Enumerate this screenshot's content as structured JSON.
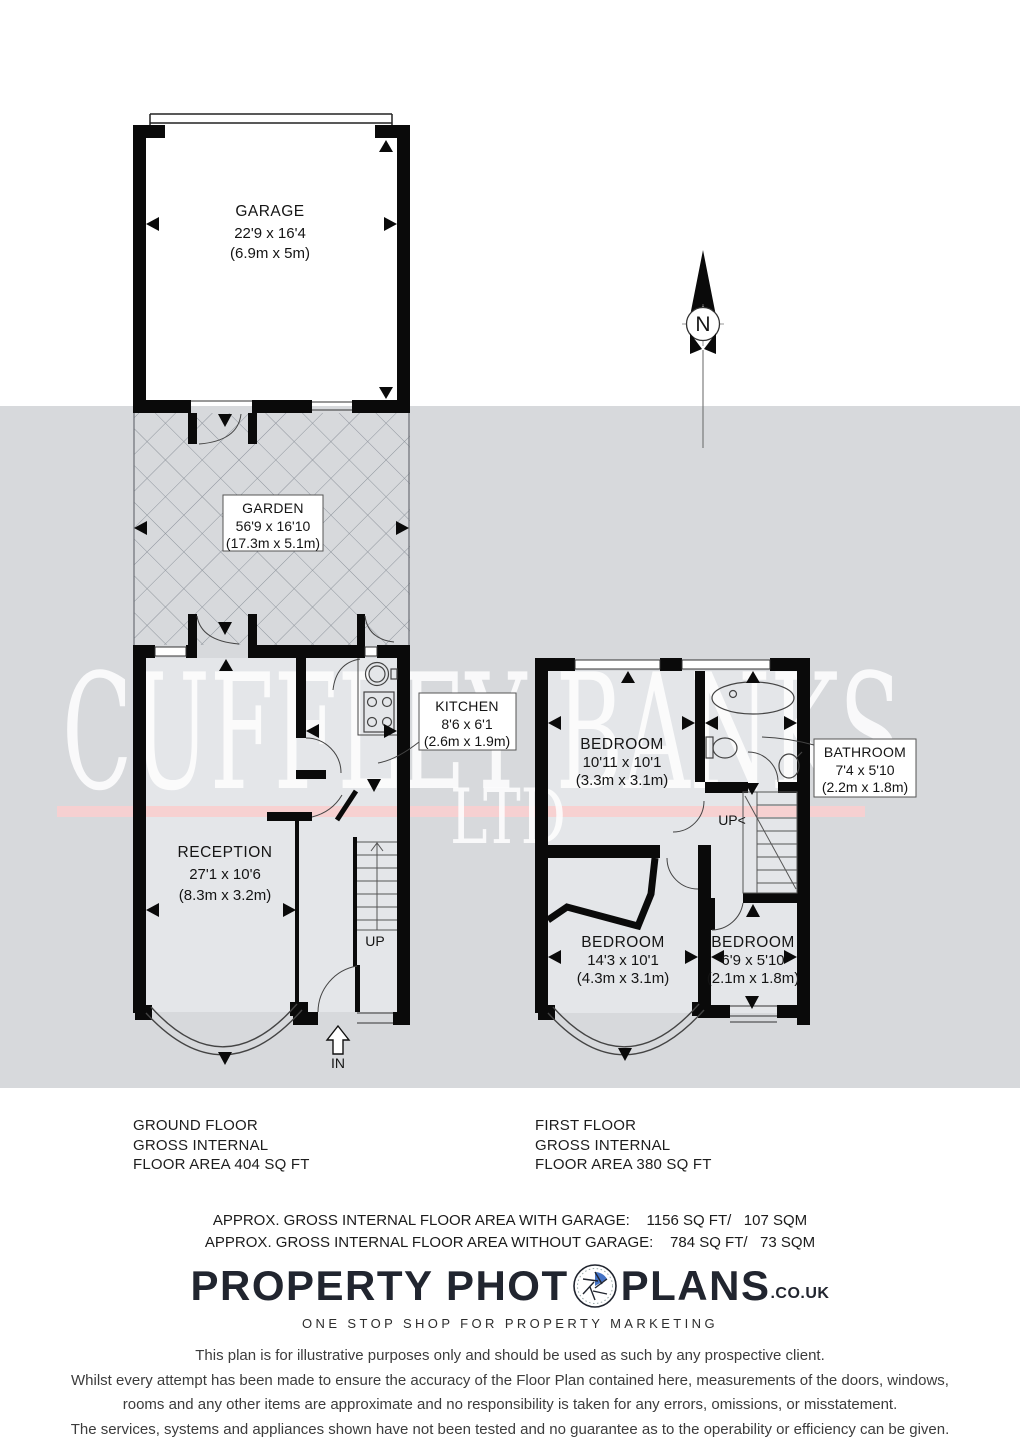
{
  "compass": {
    "letter": "N"
  },
  "watermark": {
    "name": "CUFFLEY BANKS",
    "suffix": "LTD"
  },
  "rooms": {
    "garage": {
      "name": "GARAGE",
      "imperial": "22'9 x 16'4",
      "metric": "(6.9m x 5m)"
    },
    "garden": {
      "name": "GARDEN",
      "imperial": "56'9 x 16'10",
      "metric": "(17.3m x 5.1m)"
    },
    "kitchen": {
      "name": "KITCHEN",
      "imperial": "8'6 x 6'1",
      "metric": "(2.6m x 1.9m)"
    },
    "reception": {
      "name": "RECEPTION",
      "imperial": "27'1 x 10'6",
      "metric": "(8.3m x 3.2m)"
    },
    "bedroom1": {
      "name": "BEDROOM",
      "imperial": "10'11 x 10'1",
      "metric": "(3.3m x 3.1m)"
    },
    "bathroom": {
      "name": "BATHROOM",
      "imperial": "7'4 x 5'10",
      "metric": "(2.2m x 1.8m)"
    },
    "bedroom2": {
      "name": "BEDROOM",
      "imperial": "14'3 x 10'1",
      "metric": "(4.3m x 3.1m)"
    },
    "bedroom3": {
      "name": "BEDROOM",
      "imperial": "6'9 x 5'10",
      "metric": "(2.1m x 1.8m)"
    }
  },
  "plan_labels": {
    "up_ground": "UP",
    "up_first": "UP<",
    "entrance": "IN"
  },
  "summaries": {
    "ground": {
      "line1": "GROUND FLOOR",
      "line2": "GROSS INTERNAL",
      "line3": "FLOOR AREA 404 SQ FT"
    },
    "first": {
      "line1": "FIRST FLOOR",
      "line2": "GROSS INTERNAL",
      "line3": "FLOOR AREA 380 SQ FT"
    }
  },
  "totals": {
    "with_garage": "APPROX. GROSS INTERNAL FLOOR AREA WITH GARAGE:    1156 SQ FT/   107 SQM",
    "without_garage": "APPROX. GROSS INTERNAL FLOOR AREA WITHOUT GARAGE:    784 SQ FT/   73 SQM"
  },
  "branding": {
    "logo_left": "PROPERTY PHOT",
    "logo_right": "PLANS",
    "domain": ".CO.UK",
    "tagline": "ONE STOP SHOP FOR PROPERTY MARKETING",
    "accent_blue": "#4472c4"
  },
  "disclaimer": {
    "line1": "This plan is for illustrative purposes only and should be used as such by any prospective client.",
    "line2": "Whilst every attempt has been made to ensure the accuracy of the Floor Plan contained here, measurements of the doors, windows,",
    "line3": "rooms and any other items are approximate and no responsibility is taken for any errors, omissions, or misstatement.",
    "line4": "The services, systems and appliances shown have not been tested and no guarantee as to the operability or efficiency can be given."
  },
  "colors": {
    "wall": "#0a0a0a",
    "band": "#d7d9dc",
    "stripe_pink": "#f8d0d0",
    "hatch": "#8e949c"
  }
}
